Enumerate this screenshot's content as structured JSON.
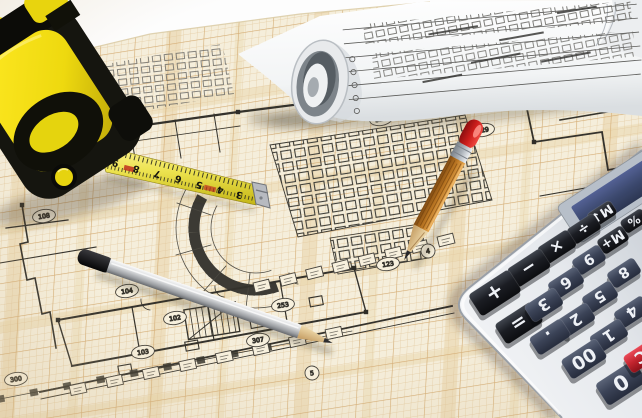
{
  "scene": {
    "title": "Architectural blueprint photo: tape measure, rolled plans, pencils and calculator on gridded floor plan"
  },
  "colors": {
    "paper": "#f5eedb",
    "grid_fine": "#e3c99e",
    "grid_bold": "#d2a86e",
    "band": "#e9d6ac",
    "ink": "#34322c",
    "tape_yellow": "#f0d911",
    "tape_black": "#15150f",
    "blade_yellow": "#ece24e",
    "pencil_silver": "#c9ccd0",
    "pencil_wood": "#c07b28",
    "eraser_red": "#d42420",
    "calc_body": "#e9ebef",
    "key_dark": "#191b20",
    "key_slate": "#3e4659",
    "key_red": "#c2242e",
    "lcd_navy": "#2c3a63"
  },
  "tape_measure": {
    "blade_numbers": [
      {
        "t": "9",
        "x": 116,
        "y": 160
      },
      {
        "t": "8",
        "x": 137,
        "y": 166
      },
      {
        "t": "7",
        "x": 158,
        "y": 171
      },
      {
        "t": "6",
        "x": 179,
        "y": 176
      },
      {
        "t": "5",
        "x": 200,
        "y": 182
      },
      {
        "t": "4",
        "x": 221,
        "y": 187
      },
      {
        "t": "3",
        "x": 240,
        "y": 192
      }
    ]
  },
  "paper": {
    "labels": [
      {
        "t": "104",
        "x": 127,
        "y": 291
      },
      {
        "t": "103",
        "x": 143,
        "y": 352
      },
      {
        "t": "102",
        "x": 175,
        "y": 318
      },
      {
        "t": "307",
        "x": 258,
        "y": 340
      },
      {
        "t": "253",
        "x": 283,
        "y": 305
      },
      {
        "t": "123",
        "x": 388,
        "y": 264
      },
      {
        "t": "324",
        "x": 381,
        "y": 119
      },
      {
        "t": "329",
        "x": 483,
        "y": 130
      },
      {
        "t": "300",
        "x": 16,
        "y": 379
      },
      {
        "t": "108",
        "x": 44,
        "y": 216
      },
      {
        "t": "4",
        "x": 428,
        "y": 251,
        "circle": true
      },
      {
        "t": "5",
        "x": 312,
        "y": 373,
        "circle": true
      }
    ],
    "label_strips": [
      {
        "x1": 262,
        "y1": 286,
        "x2": 446,
        "y2": 240,
        "n": 8
      },
      {
        "x1": 78,
        "y1": 389,
        "x2": 334,
        "y2": 333,
        "n": 8
      }
    ]
  },
  "calculator": {
    "keys": [
      {
        "t": "M↓",
        "x": 602,
        "y": 214,
        "w": 28,
        "h": 16,
        "k": "dark"
      },
      {
        "t": "÷",
        "x": 584,
        "y": 229,
        "w": 32,
        "h": 18,
        "k": "dark"
      },
      {
        "t": "×",
        "x": 557,
        "y": 247,
        "w": 36,
        "h": 20,
        "k": "dark"
      },
      {
        "t": "−",
        "x": 529,
        "y": 268,
        "w": 40,
        "h": 22,
        "k": "dark"
      },
      {
        "t": "+",
        "x": 495,
        "y": 293,
        "w": 48,
        "h": 26,
        "k": "dark"
      },
      {
        "t": "=",
        "x": 519,
        "y": 323,
        "w": 44,
        "h": 24,
        "k": "dark"
      },
      {
        "t": "%",
        "x": 634,
        "y": 221,
        "w": 26,
        "h": 15,
        "k": "dark"
      },
      {
        "t": "M+",
        "x": 613,
        "y": 240,
        "w": 30,
        "h": 17,
        "k": "dark"
      },
      {
        "t": "9",
        "x": 589,
        "y": 260,
        "w": 32,
        "h": 18,
        "k": "slate"
      },
      {
        "t": "8",
        "x": 624,
        "y": 273,
        "w": 32,
        "h": 18,
        "k": "slate"
      },
      {
        "t": "6",
        "x": 566,
        "y": 283,
        "w": 34,
        "h": 19,
        "k": "slate"
      },
      {
        "t": "5",
        "x": 600,
        "y": 297,
        "w": 34,
        "h": 19,
        "k": "slate"
      },
      {
        "t": "4",
        "x": 632,
        "y": 312,
        "w": 34,
        "h": 19,
        "k": "slate"
      },
      {
        "t": "3",
        "x": 544,
        "y": 305,
        "w": 36,
        "h": 20,
        "k": "slate"
      },
      {
        "t": "2",
        "x": 576,
        "y": 320,
        "w": 36,
        "h": 20,
        "k": "slate"
      },
      {
        "t": "1",
        "x": 609,
        "y": 336,
        "w": 36,
        "h": 20,
        "k": "slate"
      },
      {
        "t": ".",
        "x": 550,
        "y": 337,
        "w": 38,
        "h": 21,
        "k": "slate"
      },
      {
        "t": "00",
        "x": 584,
        "y": 359,
        "w": 42,
        "h": 23,
        "k": "slate"
      },
      {
        "t": "0",
        "x": 621,
        "y": 383,
        "w": 46,
        "h": 26,
        "k": "slate"
      },
      {
        "t": "C",
        "x": 641,
        "y": 357,
        "w": 32,
        "h": 20,
        "k": "red"
      }
    ]
  }
}
